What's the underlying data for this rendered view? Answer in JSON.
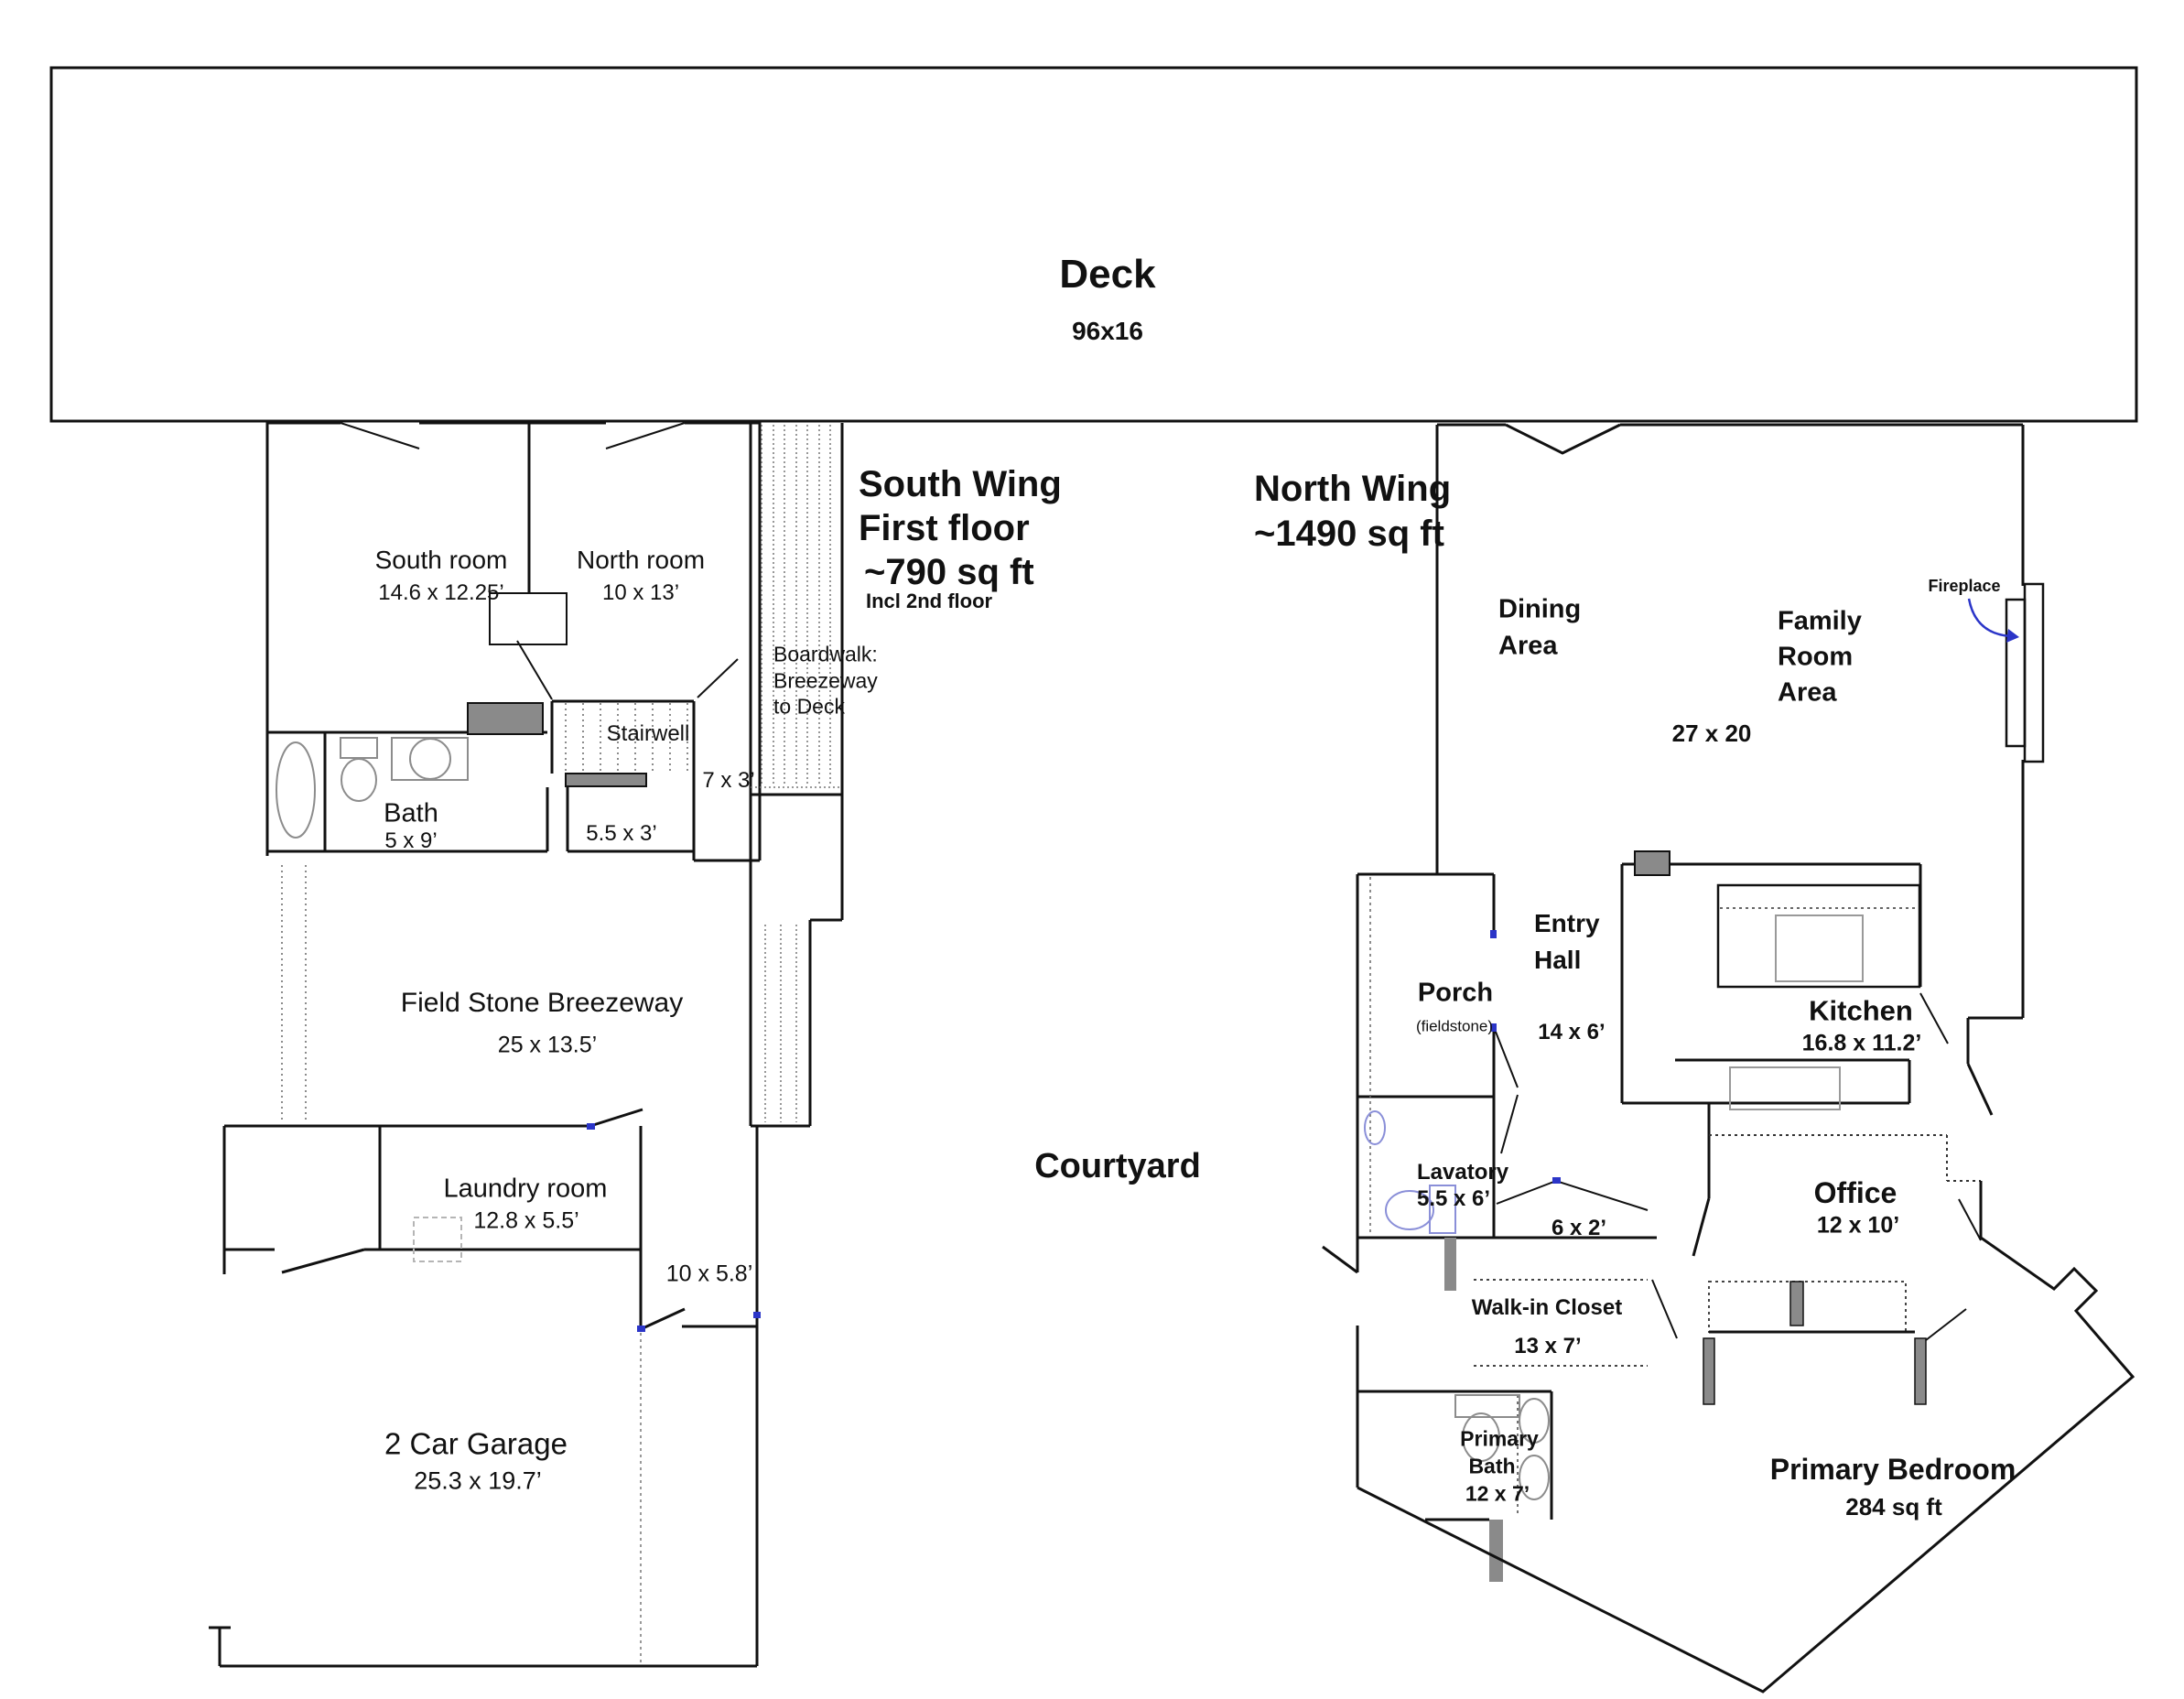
{
  "deck": {
    "name": "Deck",
    "dims": "96x16"
  },
  "courtyard_label": "Courtyard",
  "south_wing": {
    "title": "South Wing",
    "subtitle": "First floor",
    "area": "~790 sq ft",
    "note": "Incl 2nd floor",
    "south_room": {
      "name": "South room",
      "dims": "14.6 x 12.25’"
    },
    "north_room": {
      "name": "North room",
      "dims": "10 x 13’"
    },
    "bath": {
      "name": "Bath",
      "dims": "5 x 9’"
    },
    "stairwell": {
      "name": "Stairwell",
      "dims": "5.5 x 3’"
    },
    "stair_landing_dims": "7 x 3’",
    "boardwalk": {
      "line1": "Boardwalk:",
      "line2": "Breezeway",
      "line3": "to Deck"
    },
    "breezeway": {
      "name": "Field Stone Breezeway",
      "dims": "25 x 13.5’"
    },
    "laundry": {
      "name": "Laundry room",
      "dims": "12.8 x 5.5’"
    },
    "hall_dims": "10 x 5.8’",
    "garage": {
      "name": "2 Car Garage",
      "dims": "25.3 x 19.7’"
    }
  },
  "north_wing": {
    "title": "North Wing",
    "area": "~1490 sq ft",
    "dining": {
      "line1": "Dining",
      "line2": "Area"
    },
    "family": {
      "line1": "Family",
      "line2": "Room",
      "line3": "Area"
    },
    "great_room_dims": "27 x 20",
    "fireplace_label": "Fireplace",
    "porch": {
      "name": "Porch",
      "note": "(fieldstone)"
    },
    "entry_hall": {
      "line1": "Entry",
      "line2": "Hall",
      "dims": "14 x 6’"
    },
    "kitchen": {
      "name": "Kitchen",
      "dims": "16.8 x 11.2’"
    },
    "lavatory": {
      "name": "Lavatory",
      "dims": "5.5 x 6’"
    },
    "passage_dims": "6 x 2’",
    "closet": {
      "name": "Walk-in Closet",
      "dims": "13 x 7’"
    },
    "office": {
      "name": "Office",
      "dims": "12 x 10’"
    },
    "primary_bath": {
      "line1": "Primary",
      "line2": "Bath",
      "dims": "12 x 7’"
    },
    "primary_bedroom": {
      "name": "Primary Bedroom",
      "area": "284 sq ft"
    }
  },
  "colors": {
    "wall": "#111111",
    "gray_fill": "#8a8a8a",
    "fixture_stroke": "#8c8c8c",
    "blue_fixture": "#8a8fd8",
    "blue_accent": "#2b35c8",
    "dotted": "#666666"
  }
}
